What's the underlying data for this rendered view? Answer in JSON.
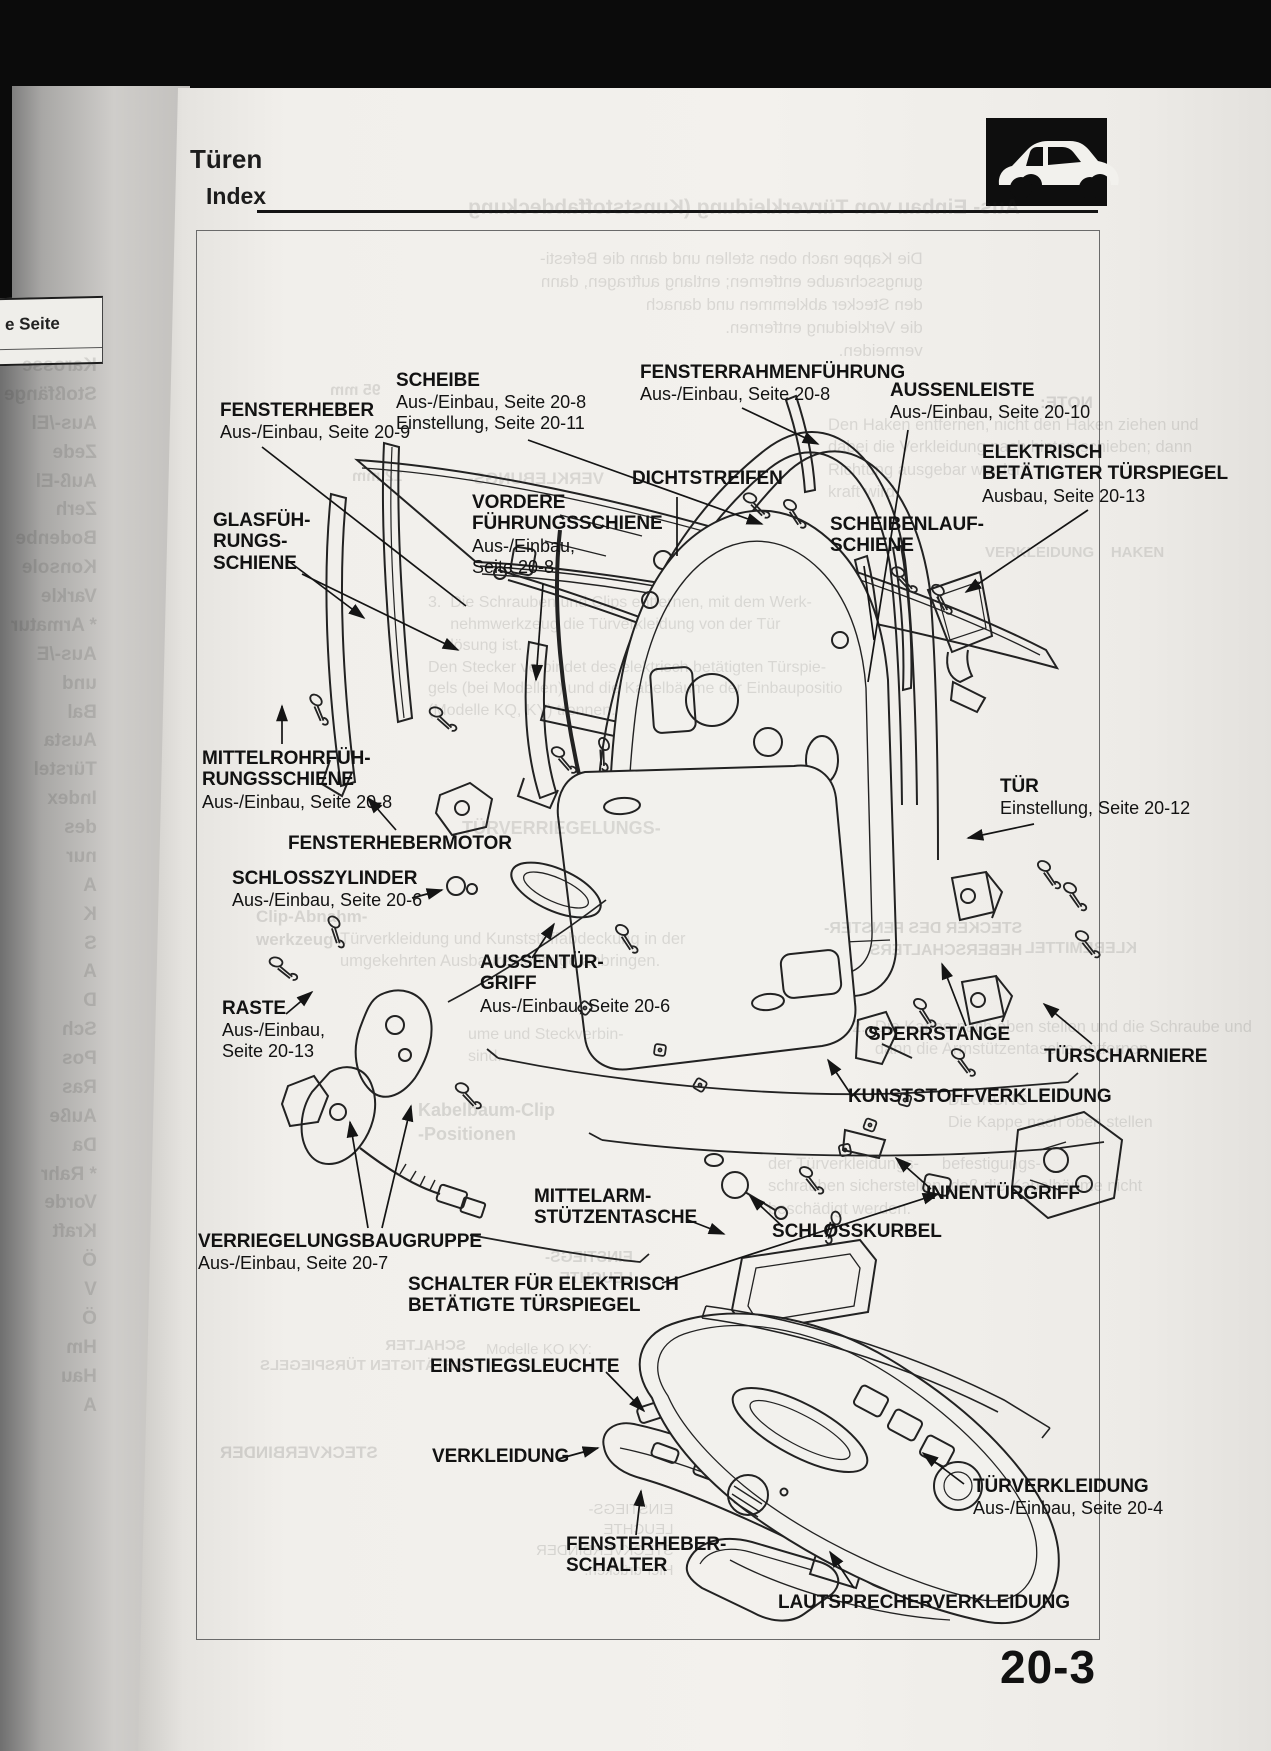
{
  "page": {
    "section_title": "Türen",
    "subsection_title": "Index",
    "page_number": "20-3",
    "icon": "car-side-silhouette-icon"
  },
  "edge_page": {
    "column_header": "e Seite"
  },
  "labels": [
    {
      "id": "fensterheber",
      "title": "FENSTERHEBER",
      "sub": "Aus-/Einbau, Seite 20-9"
    },
    {
      "id": "scheibe",
      "title": "SCHEIBE",
      "sub": "Aus-/Einbau, Seite 20-8\nEinstellung, Seite 20-11"
    },
    {
      "id": "fensterrahmenfuehrung",
      "title": "FENSTERRAHMENFÜHRUNG",
      "sub": "Aus-/Einbau, Seite 20-8"
    },
    {
      "id": "aussenleiste",
      "title": "AUSSENLEISTE",
      "sub": "Aus-/Einbau, Seite 20-10"
    },
    {
      "id": "elektrisch-betaetigter-tuerspiegel",
      "title": "ELEKTRISCH\nBETÄTIGTER TÜRSPIEGEL",
      "sub": "Ausbau, Seite 20-13"
    },
    {
      "id": "dichtstreifen",
      "title": "DICHTSTREIFEN"
    },
    {
      "id": "scheibenlaufschiene",
      "title": "SCHEIBENLAUF-\nSCHIENE"
    },
    {
      "id": "glasfuehrungsschiene",
      "title": "GLASFÜH-\nRUNGS-\nSCHIENE"
    },
    {
      "id": "vordere-fuehrungsschiene",
      "title": "VORDERE\nFÜHRUNGSSCHIENE",
      "sub": "Aus-/Einbau,\nSeite 20-8"
    },
    {
      "id": "mittelrohrfuehrungsschiene",
      "title": "MITTELROHRFÜH-\nRUNGSSCHIENE",
      "sub": "Aus-/Einbau, Seite 20-8"
    },
    {
      "id": "fensterhebermotor",
      "title": "FENSTERHEBERMOTOR"
    },
    {
      "id": "tuer",
      "title": "TÜR",
      "sub": "Einstellung, Seite 20-12"
    },
    {
      "id": "schlosszylinder",
      "title": "SCHLOSSZYLINDER",
      "sub": "Aus-/Einbau, Seite 20-6"
    },
    {
      "id": "aussentuergriff",
      "title": "AUSSENTÜR-\nGRIFF",
      "sub": "Aus-/Einbau, Seite 20-6"
    },
    {
      "id": "raste",
      "title": "RASTE",
      "sub": "Aus-/Einbau,\nSeite 20-13"
    },
    {
      "id": "sperrstange",
      "title": "SPERRSTANGE"
    },
    {
      "id": "tuerscharniere",
      "title": "TÜRSCHARNIERE"
    },
    {
      "id": "kunststoffverkleidung",
      "title": "KUNSTSTOFFVERKLEIDUNG"
    },
    {
      "id": "innentuergriff",
      "title": "INNENTÜRGRIFF"
    },
    {
      "id": "mittelarm-stuetzentasche",
      "title": "MITTELARM-\nSTÜTZENTASCHE"
    },
    {
      "id": "schlosskurbel",
      "title": "SCHLOSSKURBEL"
    },
    {
      "id": "verriegelungsbaugruppe",
      "title": "VERRIEGELUNGSBAUGRUPPE",
      "sub": "Aus-/Einbau, Seite 20-7"
    },
    {
      "id": "schalter-fuer-tuerspiegel",
      "title": "SCHALTER FÜR ELEKTRISCH\nBETÄTIGTE TÜRSPIEGEL"
    },
    {
      "id": "einstiegsleuchte",
      "title": "EINSTIEGSLEUCHTE"
    },
    {
      "id": "verkleidung",
      "title": "VERKLEIDUNG"
    },
    {
      "id": "fensterheber-schalter",
      "title": "FENSTERHEBER-\nSCHALTER"
    },
    {
      "id": "tuerverkleidung",
      "title": "TÜRVERKLEIDUNG",
      "sub": "Aus-/Einbau, Seite 20-4"
    },
    {
      "id": "lautsprecherverkleidung",
      "title": "LAUTSPRECHERVERKLEIDUNG"
    }
  ],
  "bleed": [
    {
      "text": "Aus- Einbau von Türverkleidung (Kunststoffabdeckung"
    },
    {
      "text": "Die Kappe nach oben stellen und dann die Befesti-\ngungsschraube entfernen; entlang auftragen, dann\nden Stecker abklemmen und danach\ndie Verkleidung entfernen.\nvermeiden."
    },
    {
      "text": "NOTE:"
    },
    {
      "text": "Den Haken entfernen, nicht den Haken ziehen und\ndabei die Verkleidung nach hinten schieben; dann\nRichtung ausgebar werden.\nkraft wird."
    },
    {
      "text": "VERKLEBUNGS-"
    },
    {
      "text": "VERKLEIDUNG    HAKEN"
    },
    {
      "text": "3.  Die Schrauben und Clips entfernen, mit dem Werk-\n     nehmwerkzeug die Türverkleidung von der Tür\n     lösung ist.\nDen Stecker verbindet des elektrisch betätigten Türspie-\ngels (bei Modellen) und die Kabelbäume der Einbaupositio\n(Modelle KQ, KY) trennen."
    },
    {
      "text": "Türverkleidung und Kunststoffabdeckung in der\numgekehrten Ausbaureihenfolge anbringen."
    },
    {
      "text": "Clip-Abnahm-\nwerkzeug"
    },
    {
      "text": "TÜRVERRIEGELUNGS-"
    },
    {
      "text": "STECKER DES FENSTER-\nHEBERSCHALTERS"
    },
    {
      "text": "KLEBEMITTEL"
    },
    {
      "text": "2.  Die Kappe nach oben stellen und die Schraube und\n     dann die Armstützentasche entfernen."
    },
    {
      "text": "DECKUNG\nDie Kappe nach oben stellen"
    },
    {
      "text": "der Türverkleidungs-     befestigungs-\nschrauben sicherstellen, daß die Kabelbäume nicht\nbeschädigt werden."
    },
    {
      "text": "Kabelbaum-Clip\n-Positionen"
    },
    {
      "text": "ume und Steckverbin-\nsind."
    },
    {
      "text": "EINSTIEGS-\nLEUCHTE"
    },
    {
      "text": "SCHALTER\nBETÄTIGTEN TÜRSPIEGELS"
    },
    {
      "text": "Modelle KO KY:"
    },
    {
      "text": "EINSTIEGS-\nLEUCHTE\nSTECKVERBINDER\nHier drücken."
    },
    {
      "text": "STECKVERBINDER"
    },
    {
      "text": "Karosse\nStoßfänge\nAus-/El\nZede\nAuß-El\nZerh\nBodenbe\nKonsole\nVarkle\n* Armatur\nAus-/E\nund\nBal\nAusta\nTürstel\nIndex\ndes\nnur\nA\nK\nS\nA\nD\nSch\nPos\nRas\nAuße\nDa\n* Rahr\nVorde\nKraft\nÖ\nV\nÖ\nHm\nHau\nA"
    },
    {
      "text": "95 mm"
    },
    {
      "text": "12 mm"
    }
  ]
}
